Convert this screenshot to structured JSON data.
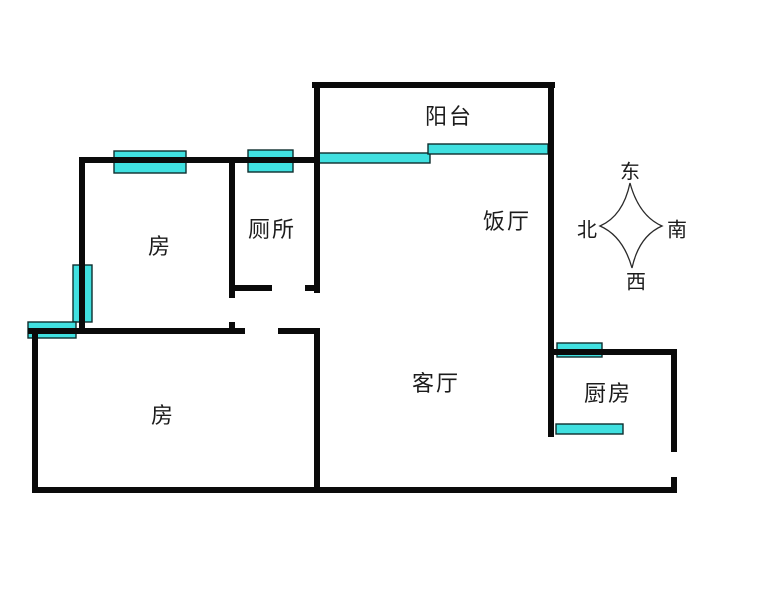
{
  "meta": {
    "width": 758,
    "height": 591
  },
  "colors": {
    "background": "#ffffff",
    "wall": "#0a0a0a",
    "window_fill": "#40e0e0",
    "window_stroke": "#0e2d2d",
    "text": "#1c1c1c"
  },
  "rooms": {
    "balcony": {
      "label": "阳台",
      "cx": 449,
      "cy": 115
    },
    "bedroom_top": {
      "label": "房",
      "cx": 160,
      "cy": 245
    },
    "toilet": {
      "label": "厕所",
      "cx": 272,
      "cy": 228
    },
    "dining": {
      "label": "饭厅",
      "cx": 507,
      "cy": 220
    },
    "living": {
      "label": "客厅",
      "cx": 436,
      "cy": 382
    },
    "kitchen": {
      "label": "厨房",
      "cx": 608,
      "cy": 392
    },
    "bedroom_bottom": {
      "label": "房",
      "cx": 163,
      "cy": 414
    }
  },
  "compass": {
    "east": {
      "text": "东",
      "cx": 630,
      "cy": 170
    },
    "north": {
      "text": "北",
      "cx": 587,
      "cy": 228
    },
    "south": {
      "text": "南",
      "cx": 677,
      "cy": 228
    },
    "west": {
      "text": "西",
      "cx": 636,
      "cy": 280
    }
  },
  "plan": {
    "wall_thickness": 6,
    "walls": [
      {
        "name": "balcony-top-wall",
        "x": 312,
        "y": 82,
        "w": 243,
        "h": 6
      },
      {
        "name": "balcony-left-wall",
        "x": 314,
        "y": 82,
        "w": 6,
        "h": 211
      },
      {
        "name": "main-right-wall",
        "x": 548,
        "y": 82,
        "w": 6,
        "h": 355
      },
      {
        "name": "north-rooms-wall",
        "x": 79,
        "y": 157,
        "w": 241,
        "h": 6
      },
      {
        "name": "bedroom-top-left-wall",
        "x": 79,
        "y": 157,
        "w": 6,
        "h": 177
      },
      {
        "name": "toilet-left-wall",
        "x": 229,
        "y": 157,
        "w": 6,
        "h": 141
      },
      {
        "name": "toilet-left-stub",
        "x": 229,
        "y": 322,
        "w": 6,
        "h": 12
      },
      {
        "name": "toilet-bottom-wall-left",
        "x": 229,
        "y": 285,
        "w": 43,
        "h": 6
      },
      {
        "name": "toilet-bottom-wall-right",
        "x": 305,
        "y": 285,
        "w": 15,
        "h": 6
      },
      {
        "name": "hall-wall-left",
        "x": 28,
        "y": 328,
        "w": 217,
        "h": 6
      },
      {
        "name": "hall-wall-right",
        "x": 278,
        "y": 328,
        "w": 42,
        "h": 6
      },
      {
        "name": "bedroom-bottom-left-wall",
        "x": 32,
        "y": 328,
        "w": 6,
        "h": 165
      },
      {
        "name": "bedroom-bottom-right-wall",
        "x": 314,
        "y": 328,
        "w": 6,
        "h": 165
      },
      {
        "name": "bottom-wall",
        "x": 32,
        "y": 487,
        "w": 644,
        "h": 6
      },
      {
        "name": "kitchen-top-wall",
        "x": 548,
        "y": 349,
        "w": 129,
        "h": 6
      },
      {
        "name": "kitchen-right-wall-upper",
        "x": 671,
        "y": 349,
        "w": 6,
        "h": 103
      },
      {
        "name": "kitchen-right-wall-lower",
        "x": 671,
        "y": 477,
        "w": 6,
        "h": 16
      }
    ],
    "windows": [
      {
        "name": "bedroom-top-window",
        "x": 114,
        "y": 151,
        "w": 72,
        "h": 22
      },
      {
        "name": "toilet-window",
        "x": 248,
        "y": 150,
        "w": 45,
        "h": 22
      },
      {
        "name": "balcony-window-left",
        "x": 318,
        "y": 153,
        "w": 112,
        "h": 10
      },
      {
        "name": "balcony-window-right",
        "x": 428,
        "y": 144,
        "w": 120,
        "h": 10
      },
      {
        "name": "bedroom-top-side-window",
        "x": 73,
        "y": 265,
        "w": 19,
        "h": 57
      },
      {
        "name": "bedroom-bottom-window",
        "x": 28,
        "y": 322,
        "w": 48,
        "h": 16
      },
      {
        "name": "kitchen-top-window",
        "x": 557,
        "y": 343,
        "w": 45,
        "h": 14
      },
      {
        "name": "kitchen-inner-window",
        "x": 556,
        "y": 424,
        "w": 67,
        "h": 10
      }
    ]
  }
}
